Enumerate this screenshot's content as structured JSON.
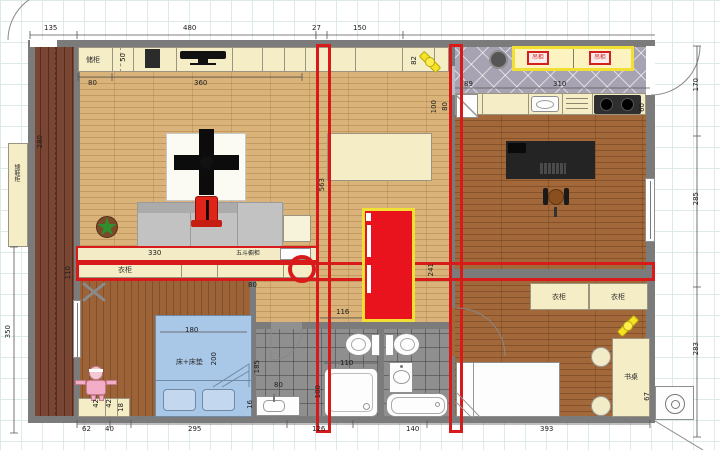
{
  "palette": {
    "red": "#d81a1a",
    "yellow": "#f2df33",
    "wall_gray": "#7b7b7b",
    "cream": "#f4edc6",
    "bed_blue": "#a9c7e7"
  },
  "labels": {
    "shoe_cabinet": "矮鞋柜",
    "storage_cabinet": "储柜",
    "wardrobe_living": "衣柜",
    "five_drawer_chest": "五斗橱柜",
    "bed_left": "床+床垫",
    "wardrobe_right_1": "衣柜",
    "wardrobe_right_2": "衣柜",
    "desk_right": "书桌",
    "kitchen_box_1": "吊柜",
    "kitchen_box_2": "吊柜"
  },
  "dims": [
    {
      "t": "135",
      "x": 44,
      "y": 24
    },
    {
      "t": "480",
      "x": 183,
      "y": 24
    },
    {
      "t": "27",
      "x": 312,
      "y": 24
    },
    {
      "t": "150",
      "x": 353,
      "y": 24
    },
    {
      "t": "80",
      "x": 88,
      "y": 79
    },
    {
      "t": "360",
      "x": 194,
      "y": 79
    },
    {
      "t": "50",
      "x": 119,
      "y": 53,
      "r": 1
    },
    {
      "t": "280",
      "x": 36,
      "y": 135,
      "r": 1
    },
    {
      "t": "350",
      "x": 4,
      "y": 325,
      "r": 1
    },
    {
      "t": "330",
      "x": 148,
      "y": 249
    },
    {
      "t": "80",
      "x": 248,
      "y": 281
    },
    {
      "t": "110",
      "x": 64,
      "y": 266,
      "r": 1
    },
    {
      "t": "563",
      "x": 318,
      "y": 178,
      "r": 1
    },
    {
      "t": "82",
      "x": 410,
      "y": 56,
      "r": 1
    },
    {
      "t": "89",
      "x": 464,
      "y": 80
    },
    {
      "t": "100",
      "x": 430,
      "y": 100,
      "r": 1
    },
    {
      "t": "80",
      "x": 441,
      "y": 102,
      "r": 1
    },
    {
      "t": "310",
      "x": 553,
      "y": 80
    },
    {
      "t": "60",
      "x": 638,
      "y": 103,
      "r": 1
    },
    {
      "t": "170",
      "x": 692,
      "y": 78,
      "r": 1
    },
    {
      "t": "285",
      "x": 692,
      "y": 192,
      "r": 1
    },
    {
      "t": "283",
      "x": 692,
      "y": 342,
      "r": 1
    },
    {
      "t": "116",
      "x": 336,
      "y": 308
    },
    {
      "t": "241",
      "x": 427,
      "y": 263,
      "r": 1
    },
    {
      "t": "180",
      "x": 185,
      "y": 326
    },
    {
      "t": "200",
      "x": 210,
      "y": 352,
      "r": 1
    },
    {
      "t": "185",
      "x": 253,
      "y": 360,
      "r": 1
    },
    {
      "t": "80",
      "x": 274,
      "y": 381
    },
    {
      "t": "110",
      "x": 340,
      "y": 359
    },
    {
      "t": "100",
      "x": 314,
      "y": 385,
      "r": 1
    },
    {
      "t": "16",
      "x": 246,
      "y": 400,
      "r": 1
    },
    {
      "t": "42",
      "x": 92,
      "y": 399,
      "r": 1
    },
    {
      "t": "42",
      "x": 105,
      "y": 399,
      "r": 1
    },
    {
      "t": "18",
      "x": 117,
      "y": 403,
      "r": 1
    },
    {
      "t": "67",
      "x": 643,
      "y": 392,
      "r": 1
    },
    {
      "t": "62",
      "x": 82,
      "y": 425
    },
    {
      "t": "40",
      "x": 105,
      "y": 425
    },
    {
      "t": "295",
      "x": 188,
      "y": 425
    },
    {
      "t": "126",
      "x": 312,
      "y": 425
    },
    {
      "t": "140",
      "x": 406,
      "y": 425
    },
    {
      "t": "393",
      "x": 540,
      "y": 425
    }
  ]
}
